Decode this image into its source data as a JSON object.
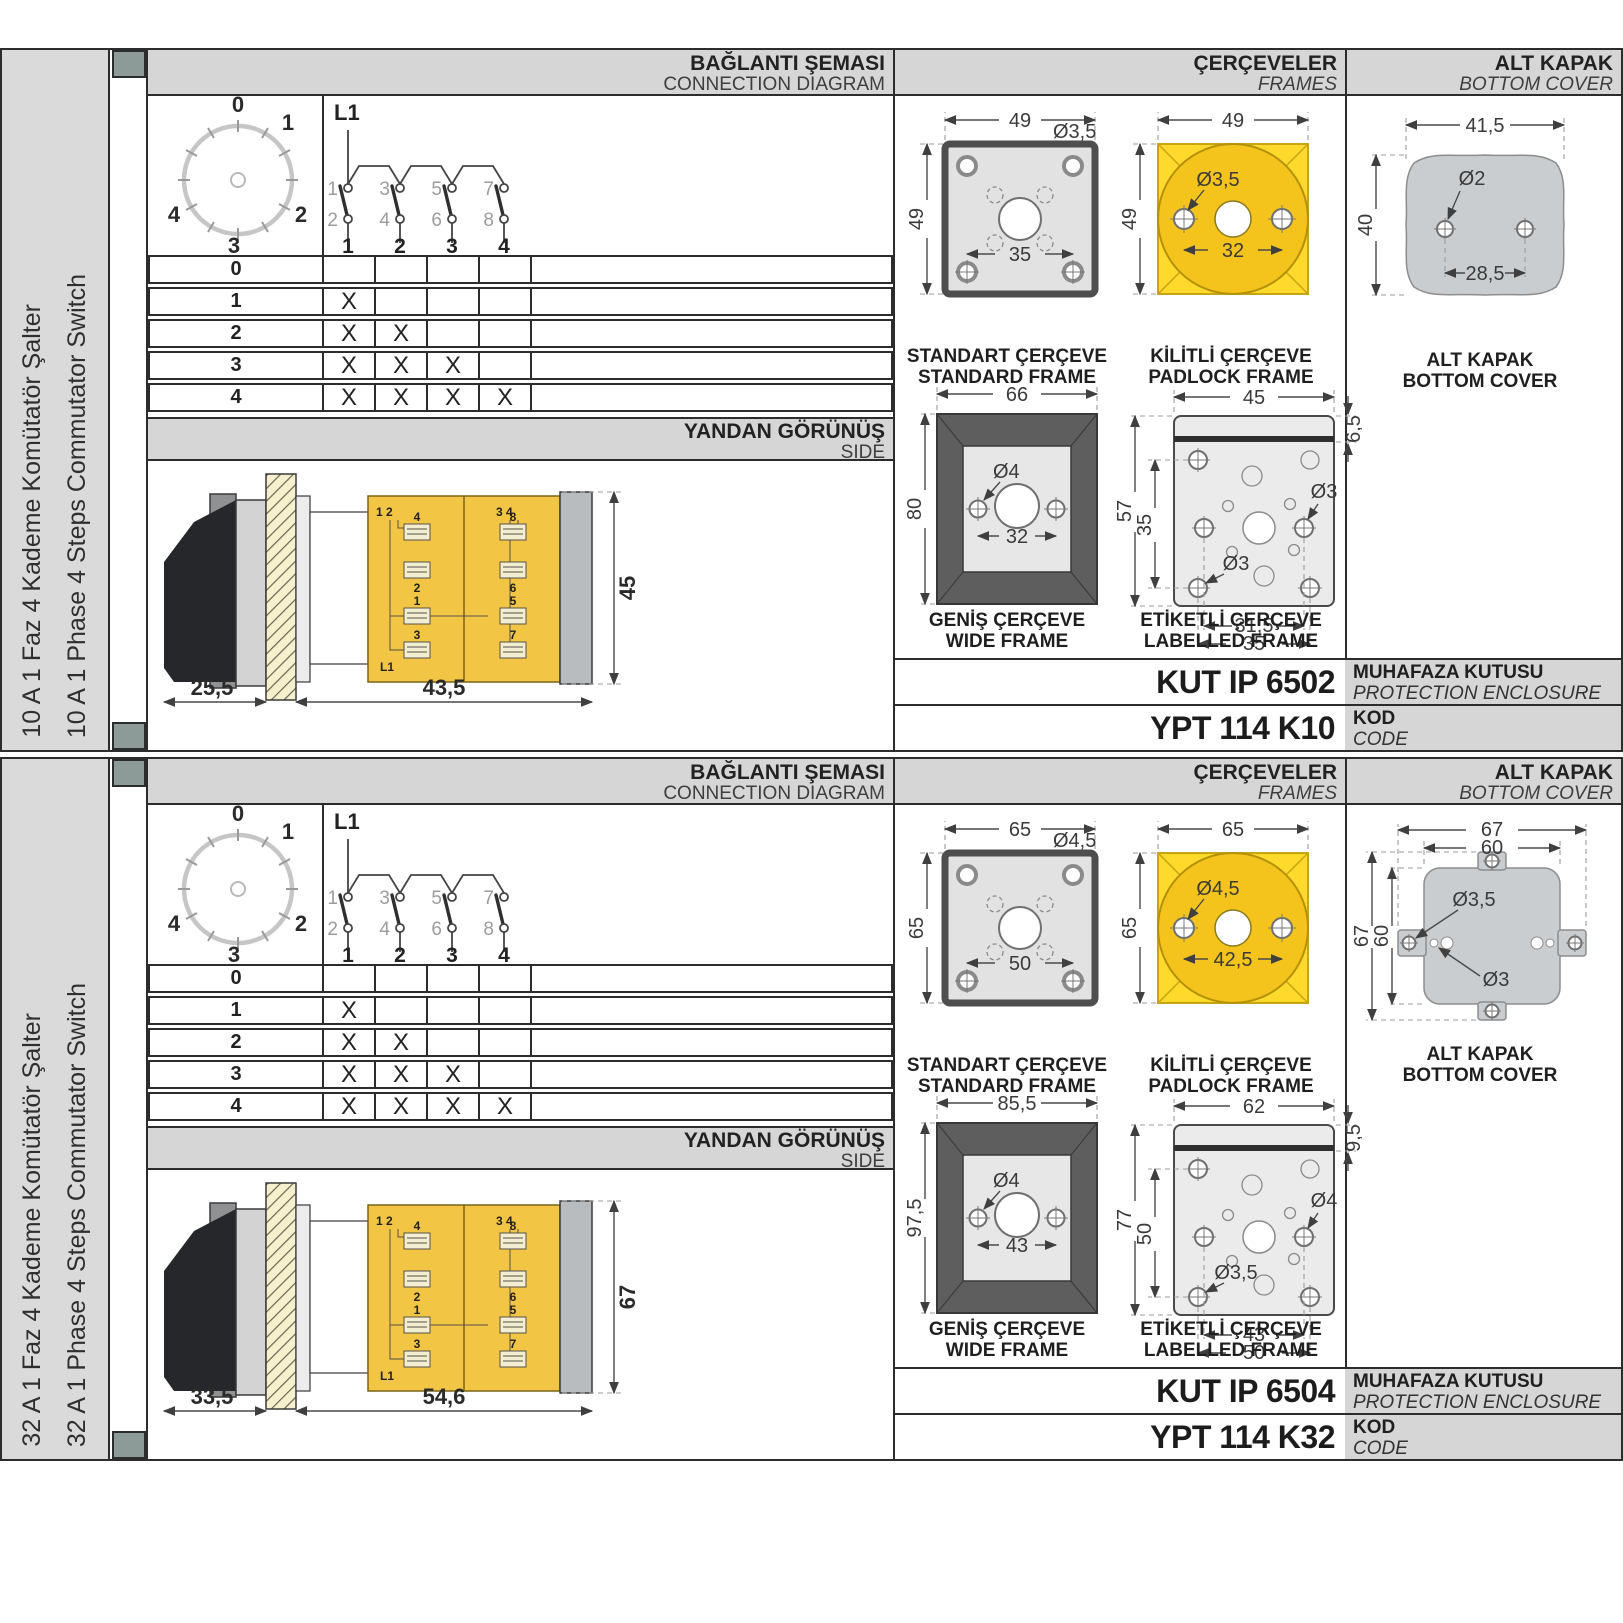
{
  "palette": {
    "yellow": "#f5c41c",
    "yellow-bright": "#ffd92b",
    "body-yellow": "#f2c544",
    "panel": "#d6d6d6",
    "sidebar": "#dadada",
    "tab": "#8d9b98",
    "ink": "#2c2c2c"
  },
  "sections": [
    {
      "sidebar_tr": "10 A 1 Faz 4 Kademe Komütatör Şalter",
      "sidebar_en": "10 A 1 Phase 4 Steps Commutator Switch",
      "head": {
        "connection_tr": "BAĞLANTI ŞEMASI",
        "connection_en": "CONNECTION DIAGRAM",
        "frames_tr": "ÇERÇEVELER",
        "frames_en": "FRAMES",
        "cover_tr": "ALT KAPAK",
        "cover_en": "BOTTOM COVER"
      },
      "dial": {
        "p0": "0",
        "p1": "1",
        "p2": "2",
        "p3": "3",
        "p4": "4"
      },
      "circuit": {
        "feed": "L1",
        "top": [
          "1",
          "3",
          "5",
          "7"
        ],
        "bottom": [
          "2",
          "4",
          "6",
          "8"
        ],
        "out": [
          "1",
          "2",
          "3",
          "4"
        ]
      },
      "table": {
        "rows": [
          {
            "label": "0",
            "m": [
              "",
              "",
              "",
              ""
            ]
          },
          {
            "label": "1",
            "m": [
              "X",
              "",
              "",
              ""
            ]
          },
          {
            "label": "2",
            "m": [
              "X",
              "X",
              "",
              ""
            ]
          },
          {
            "label": "3",
            "m": [
              "X",
              "X",
              "X",
              ""
            ]
          },
          {
            "label": "4",
            "m": [
              "X",
              "X",
              "X",
              "X"
            ]
          }
        ]
      },
      "side": {
        "tr": "YANDAN GÖRÜNÜŞ",
        "en": "SIDE",
        "dim_front": "25,5",
        "dim_body": "43,5",
        "dim_height": "45",
        "corner_l": "1 2",
        "corner_r": "3 4",
        "t_l": [
          "4",
          "2",
          "1",
          "3"
        ],
        "t_r": [
          "8",
          "6",
          "5",
          "7"
        ],
        "feed": "L1"
      },
      "standard": {
        "cap_tr": "STANDART ÇERÇEVE",
        "cap_en": "STANDARD FRAME",
        "w": "49",
        "h": "49",
        "hole": "Ø3,5",
        "pitch": "35"
      },
      "padlock": {
        "cap_tr": "KİLİTLİ ÇERÇEVE",
        "cap_en": "PADLOCK FRAME",
        "w": "49",
        "h": "49",
        "hole": "Ø3,5",
        "pitch": "32"
      },
      "wide": {
        "cap_tr": "GENİŞ ÇERÇEVE",
        "cap_en": "WIDE FRAME",
        "w": "66",
        "h": "80",
        "hole": "Ø4",
        "pitch": "32"
      },
      "labelled": {
        "cap_tr": "ETİKETLİ ÇERÇEVE",
        "cap_en": "LABELLED FRAME",
        "w": "45",
        "strip": "6,5",
        "h_outer": "57",
        "h_inner": "35",
        "hole_r": "Ø3",
        "hole_l": "Ø3",
        "pitch_inner": "31,5",
        "pitch_outer": "35"
      },
      "cover": {
        "cap_tr": "ALT KAPAK",
        "cap_en": "BOTTOM COVER",
        "w": "41,5",
        "h": "40",
        "hole": "Ø2",
        "pitch": "28,5"
      },
      "codes": {
        "enclosure": "KUT IP 6502",
        "enclosure_tr": "MUHAFAZA KUTUSU",
        "enclosure_en": "PROTECTION ENCLOSURE",
        "code": "YPT 114 K10",
        "code_tr": "KOD",
        "code_en": "CODE"
      }
    },
    {
      "sidebar_tr": "32 A 1 Faz 4 Kademe Komütatör Şalter",
      "sidebar_en": "32 A 1 Phase 4 Steps Commutator Switch",
      "head": {
        "connection_tr": "BAĞLANTI ŞEMASI",
        "connection_en": "CONNECTION DIAGRAM",
        "frames_tr": "ÇERÇEVELER",
        "frames_en": "FRAMES",
        "cover_tr": "ALT KAPAK",
        "cover_en": "BOTTOM COVER"
      },
      "dial": {
        "p0": "0",
        "p1": "1",
        "p2": "2",
        "p3": "3",
        "p4": "4"
      },
      "circuit": {
        "feed": "L1",
        "top": [
          "1",
          "3",
          "5",
          "7"
        ],
        "bottom": [
          "2",
          "4",
          "6",
          "8"
        ],
        "out": [
          "1",
          "2",
          "3",
          "4"
        ]
      },
      "table": {
        "rows": [
          {
            "label": "0",
            "m": [
              "",
              "",
              "",
              ""
            ]
          },
          {
            "label": "1",
            "m": [
              "X",
              "",
              "",
              ""
            ]
          },
          {
            "label": "2",
            "m": [
              "X",
              "X",
              "",
              ""
            ]
          },
          {
            "label": "3",
            "m": [
              "X",
              "X",
              "X",
              ""
            ]
          },
          {
            "label": "4",
            "m": [
              "X",
              "X",
              "X",
              "X"
            ]
          }
        ]
      },
      "side": {
        "tr": "YANDAN GÖRÜNÜŞ",
        "en": "SIDE",
        "dim_front": "33,5",
        "dim_body": "54,6",
        "dim_height": "67",
        "corner_l": "1 2",
        "corner_r": "3 4",
        "t_l": [
          "4",
          "2",
          "1",
          "3"
        ],
        "t_r": [
          "8",
          "6",
          "5",
          "7"
        ],
        "feed": "L1"
      },
      "standard": {
        "cap_tr": "STANDART ÇERÇEVE",
        "cap_en": "STANDARD FRAME",
        "w": "65",
        "h": "65",
        "hole": "Ø4,5",
        "pitch": "50"
      },
      "padlock": {
        "cap_tr": "KİLİTLİ ÇERÇEVE",
        "cap_en": "PADLOCK FRAME",
        "w": "65",
        "h": "65",
        "hole": "Ø4,5",
        "pitch": "42,5"
      },
      "wide": {
        "cap_tr": "GENİŞ ÇERÇEVE",
        "cap_en": "WIDE FRAME",
        "w": "85,5",
        "h": "97,5",
        "hole": "Ø4",
        "pitch": "43"
      },
      "labelled": {
        "cap_tr": "ETİKETLİ ÇERÇEVE",
        "cap_en": "LABELLED FRAME",
        "w": "62",
        "strip": "9,5",
        "h_outer": "77",
        "h_inner": "50",
        "hole_r": "Ø4",
        "hole_l": "Ø3,5",
        "pitch_inner": "43",
        "pitch_outer": "50"
      },
      "cover": {
        "cap_tr": "ALT KAPAK",
        "cap_en": "BOTTOM COVER",
        "w_outer": "67",
        "w_inner": "60",
        "h_outer": "67",
        "h_inner": "60",
        "hole_tab": "Ø3,5",
        "hole_small": "Ø3"
      },
      "codes": {
        "enclosure": "KUT IP 6504",
        "enclosure_tr": "MUHAFAZA KUTUSU",
        "enclosure_en": "PROTECTION ENCLOSURE",
        "code": "YPT 114 K32",
        "code_tr": "KOD",
        "code_en": "CODE"
      }
    }
  ]
}
